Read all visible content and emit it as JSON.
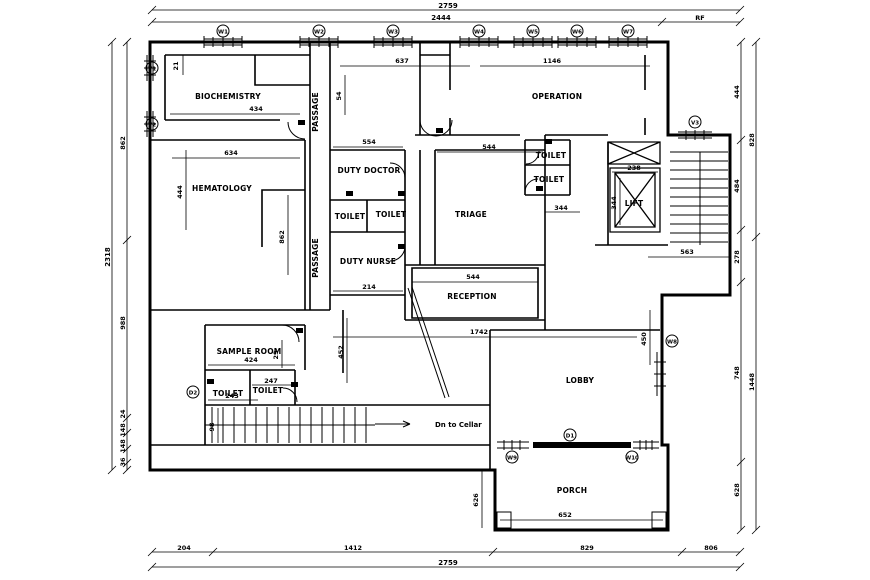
{
  "colors": {
    "ink": "#000000",
    "paper": "#ffffff"
  },
  "rooms": [
    "BIOCHEMISTRY",
    "HEMATOLOGY",
    "PASSAGE",
    "PASSAGE",
    "DUTY DOCTOR",
    "TOILET",
    "TOILET",
    "DUTY NURSE",
    "TRIAGE",
    "OPERATION",
    "TOILET",
    "TOILET",
    "LIFT",
    "RECEPTION",
    "SAMPLE ROOM",
    "TOILET",
    "TOILET",
    "LOBBY",
    "PORCH"
  ],
  "notes": {
    "stairs": "Dn to Cellar"
  },
  "dimensions": {
    "top_outer": "2759",
    "top_inner": [
      "2444",
      "RF"
    ],
    "bottom_inner": [
      "204",
      "1412",
      "829",
      "806"
    ],
    "bottom_outer": "2759",
    "left_outer": "2318",
    "left_inner": [
      "862",
      "988",
      "24",
      "148",
      "148",
      "36"
    ],
    "right_inner": [
      "444",
      "484",
      "278",
      "748",
      "628"
    ],
    "right_outer": [
      "828",
      "1448"
    ],
    "interior": [
      "21",
      "637",
      "1146",
      "434",
      "634",
      "444",
      "862",
      "554",
      "544",
      "214",
      "544",
      "1742",
      "238",
      "344",
      "344",
      "563",
      "450",
      "452",
      "424",
      "247",
      "243",
      "29",
      "652",
      "626",
      "98",
      "54"
    ]
  },
  "tags": {
    "windows": [
      "W1",
      "W2",
      "W3",
      "W4",
      "W5",
      "W6",
      "W7",
      "W8",
      "W9",
      "W10"
    ],
    "vents": [
      "V1",
      "V2",
      "V3"
    ],
    "doors": [
      "D1",
      "D2"
    ]
  }
}
